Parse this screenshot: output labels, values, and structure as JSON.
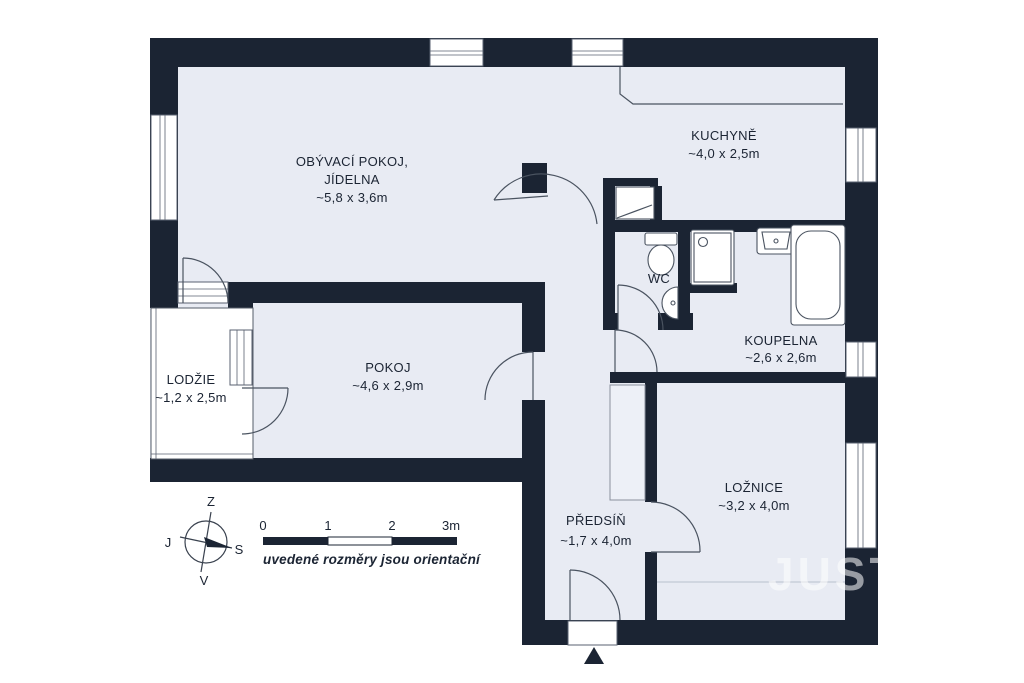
{
  "colors": {
    "wall": "#1b2433",
    "floor": "#e8ebf3",
    "white": "#ffffff",
    "line": "#4a5360"
  },
  "rooms": {
    "living": {
      "name": "OBÝVACÍ POKOJ,",
      "name2": "JÍDELNA",
      "dims": "~5,8 x 3,6m"
    },
    "kitchen": {
      "name": "KUCHYNĚ",
      "dims": "~4,0 x 2,5m"
    },
    "wc": {
      "name": "WC"
    },
    "bathroom": {
      "name": "KOUPELNA",
      "dims": "~2,6 x 2,6m"
    },
    "room": {
      "name": "POKOJ",
      "dims": "~4,6 x 2,9m"
    },
    "loggia": {
      "name": "LODŽIE",
      "dims": "~1,2 x 2,5m"
    },
    "hallway": {
      "name": "PŘEDSÍŇ",
      "dims": "~1,7 x 4,0m"
    },
    "bedroom": {
      "name": "LOŽNICE",
      "dims": "~3,2 x 4,0m"
    }
  },
  "compass": {
    "top": "Z",
    "left": "J",
    "right": "S",
    "bottom": "V"
  },
  "scale_bar": {
    "tick0": "0",
    "tick1": "1",
    "tick2": "2",
    "tick3": "3m",
    "disclaimer": "uvedené rozměry jsou orientační"
  },
  "watermark": "JUSTO"
}
